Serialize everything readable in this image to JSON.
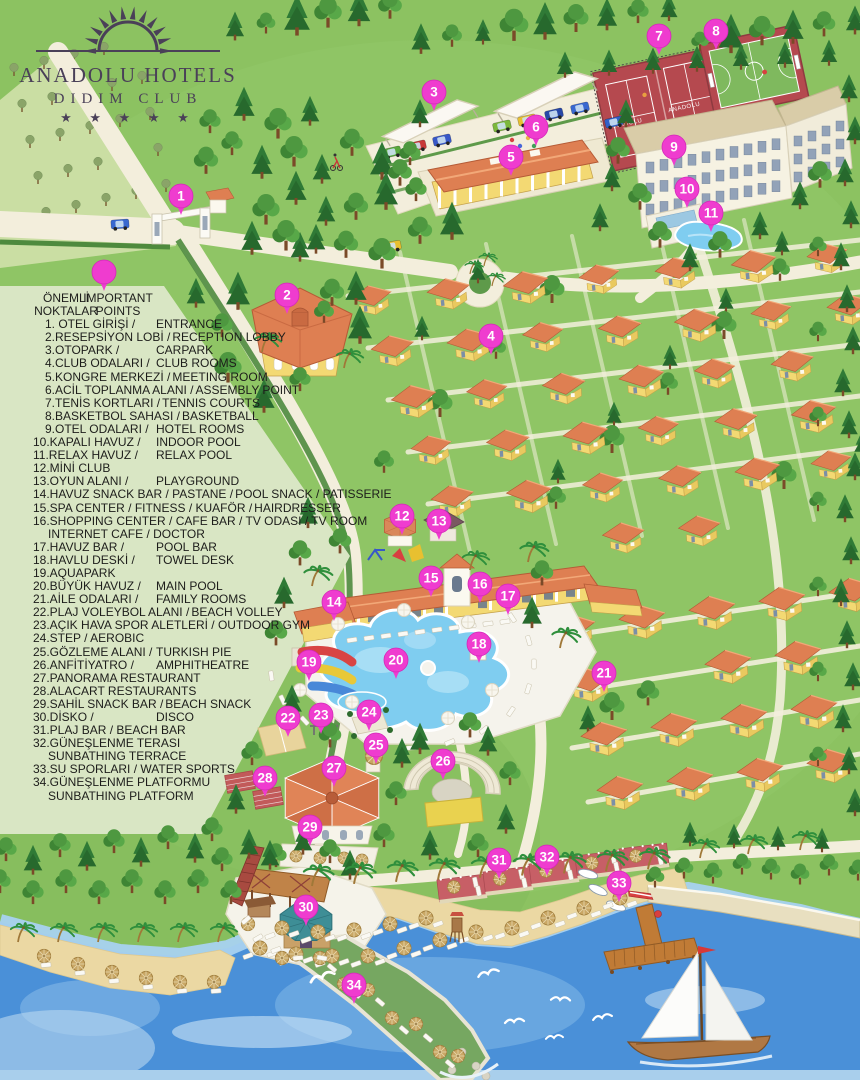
{
  "logo": {
    "name": "ANADOLU HOTELS",
    "sub": "DIDIM CLUB",
    "stars": "★ ★ ★ ★ ★"
  },
  "legend": {
    "header": {
      "tr1": "ÖNEMLİ",
      "tr2": "NOKTALAR",
      "en1": "IMPORTANT",
      "en2": "POINTS"
    },
    "items": [
      {
        "n": 1,
        "tr": "1. OTEL GİRİŞİ /",
        "en": "ENTRANCE"
      },
      {
        "n": 2,
        "tr": "2.RESEPSİYON LOBİ /",
        "en": "RECEPTION LOBBY"
      },
      {
        "n": 3,
        "tr": "3.OTOPARK /",
        "en": "CARPARK"
      },
      {
        "n": 4,
        "tr": "4.CLUB ODALARI /",
        "en": "CLUB ROOMS"
      },
      {
        "n": 5,
        "tr": "5.KONGRE MERKEZİ /",
        "en": "MEETING ROOM"
      },
      {
        "n": 6,
        "tr": "6.ACİL TOPLANMA ALANI /",
        "en": "ASSEMBLY POINT"
      },
      {
        "n": 7,
        "tr": "7.TENİS KORTLARI /",
        "en": "TENNIS COURTS"
      },
      {
        "n": 8,
        "tr": "8.BASKETBOL SAHASI /",
        "en": "BASKETBALL"
      },
      {
        "n": 9,
        "tr": "9.OTEL ODALARI /",
        "en": "HOTEL ROOMS"
      },
      {
        "n": 10,
        "tr": "10.KAPALI HAVUZ /",
        "en": "INDOOR POOL"
      },
      {
        "n": 11,
        "tr": "11.RELAX HAVUZ /",
        "en": "RELAX POOL"
      },
      {
        "n": 12,
        "tr": "12.MİNİ CLUB",
        "en": ""
      },
      {
        "n": 13,
        "tr": "13.OYUN ALANI /",
        "en": "PLAYGROUND"
      },
      {
        "n": 14,
        "tr": "14.HAVUZ SNACK BAR / PASTANE /",
        "en": "POOL SNACK / PATISSERIE"
      },
      {
        "n": 15,
        "tr": "15.SPA CENTER / FITNESS / KUAFÖR /",
        "en": "HAIRDRESSER"
      },
      {
        "n": 16,
        "tr": "16.SHOPPING CENTER / CAFE BAR / TV ODASI / TV ROOM",
        "en": "",
        "line2": "INTERNET CAFE / DOCTOR"
      },
      {
        "n": 17,
        "tr": "17.HAVUZ BAR /",
        "en": "POOL BAR"
      },
      {
        "n": 18,
        "tr": "18.HAVLU DESKİ /",
        "en": "TOWEL DESK"
      },
      {
        "n": 19,
        "tr": "19.AQUAPARK",
        "en": ""
      },
      {
        "n": 20,
        "tr": "20.BÜYÜK HAVUZ /",
        "en": "MAIN POOL"
      },
      {
        "n": 21,
        "tr": "21.AİLE ODALARI /",
        "en": "FAMILY ROOMS"
      },
      {
        "n": 22,
        "tr": "22.PLAJ VOLEYBOL ALANI /",
        "en": "BEACH VOLLEY"
      },
      {
        "n": 23,
        "tr": "23.AÇIK HAVA SPOR ALETLERİ / OUTDOOR GYM",
        "en": ""
      },
      {
        "n": 24,
        "tr": "24.STEP / AEROBIC",
        "en": ""
      },
      {
        "n": 25,
        "tr": "25.GÖZLEME ALANI /",
        "en": "TURKISH PIE"
      },
      {
        "n": 26,
        "tr": "26.ANFİTİYATRO /",
        "en": "AMPHITHEATRE"
      },
      {
        "n": 27,
        "tr": "27.PANORAMA RESTAURANT",
        "en": ""
      },
      {
        "n": 28,
        "tr": "28.ALACART RESTAURANTS",
        "en": ""
      },
      {
        "n": 29,
        "tr": "29.SAHİL SNACK BAR /",
        "en": "BEACH SNACK"
      },
      {
        "n": 30,
        "tr": "30.DİSKO /",
        "en": "DISCO"
      },
      {
        "n": 31,
        "tr": "31.PLAJ BAR / BEACH BAR",
        "en": ""
      },
      {
        "n": 32,
        "tr": "32.GÜNEŞLENME TERASI",
        "en": "",
        "line2": "SUNBATHING TERRACE"
      },
      {
        "n": 33,
        "tr": "33.SU SPORLARI / WATER SPORTS",
        "en": ""
      },
      {
        "n": 34,
        "tr": "34.GÜNEŞLENME  PLATFORMU",
        "en": "",
        "line2": "SUNBATHING PLATFORM"
      }
    ]
  },
  "map": {
    "tennis_text": "ANADOLU",
    "sample_marker": {
      "x": 104,
      "y": 272
    },
    "markers": [
      {
        "n": "1",
        "x": 181,
        "y": 196
      },
      {
        "n": "2",
        "x": 287,
        "y": 295
      },
      {
        "n": "3",
        "x": 434,
        "y": 92
      },
      {
        "n": "4",
        "x": 491,
        "y": 336
      },
      {
        "n": "5",
        "x": 511,
        "y": 157
      },
      {
        "n": "6",
        "x": 536,
        "y": 127
      },
      {
        "n": "7",
        "x": 659,
        "y": 36
      },
      {
        "n": "8",
        "x": 716,
        "y": 31
      },
      {
        "n": "9",
        "x": 674,
        "y": 147
      },
      {
        "n": "10",
        "x": 687,
        "y": 189
      },
      {
        "n": "11",
        "x": 711,
        "y": 213
      },
      {
        "n": "12",
        "x": 402,
        "y": 516
      },
      {
        "n": "13",
        "x": 439,
        "y": 521
      },
      {
        "n": "14",
        "x": 334,
        "y": 602
      },
      {
        "n": "15",
        "x": 431,
        "y": 578
      },
      {
        "n": "16",
        "x": 480,
        "y": 584
      },
      {
        "n": "17",
        "x": 508,
        "y": 596
      },
      {
        "n": "18",
        "x": 479,
        "y": 644
      },
      {
        "n": "19",
        "x": 309,
        "y": 662
      },
      {
        "n": "20",
        "x": 396,
        "y": 660
      },
      {
        "n": "21",
        "x": 604,
        "y": 673
      },
      {
        "n": "22",
        "x": 288,
        "y": 718
      },
      {
        "n": "23",
        "x": 321,
        "y": 715
      },
      {
        "n": "24",
        "x": 369,
        "y": 712
      },
      {
        "n": "25",
        "x": 376,
        "y": 745
      },
      {
        "n": "26",
        "x": 443,
        "y": 761
      },
      {
        "n": "27",
        "x": 334,
        "y": 768
      },
      {
        "n": "28",
        "x": 265,
        "y": 778
      },
      {
        "n": "29",
        "x": 310,
        "y": 827
      },
      {
        "n": "30",
        "x": 306,
        "y": 907
      },
      {
        "n": "31",
        "x": 499,
        "y": 860
      },
      {
        "n": "32",
        "x": 547,
        "y": 857
      },
      {
        "n": "33",
        "x": 619,
        "y": 883
      },
      {
        "n": "34",
        "x": 354,
        "y": 985
      }
    ]
  },
  "colors": {
    "grass": "#8CC261",
    "legendbg": "#D9E6C4",
    "road": "#F3EEDC",
    "roof": "#DE7F52",
    "wall": "#F3D973",
    "sea": "#4A90D8",
    "shallow": "#A8D2F0",
    "sand": "#EBD8A3",
    "pool": "#7FCDF0",
    "marker": "#EF3CCF",
    "logo": "#4A4058",
    "ink": "#1D1D1B",
    "court": "#B5494F",
    "courtgreen": "#7FB95E",
    "deck": "#F5F3EC",
    "plaza": "#F5F3EA",
    "wood": "#C07B36",
    "disco": "#3E8E96",
    "terrace": "#C75F66"
  }
}
